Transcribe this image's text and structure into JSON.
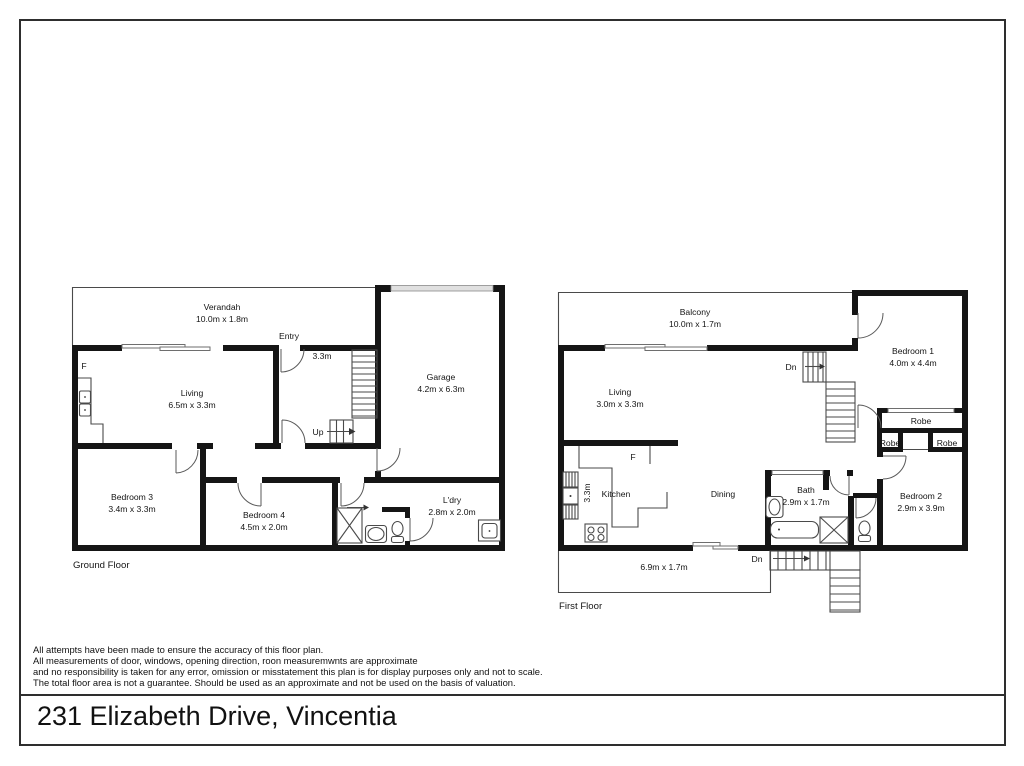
{
  "page": {
    "address": "231 Elizabeth Drive, Vincentia",
    "disclaimer": [
      "All attempts have been made to ensure the accuracy of this floor plan.",
      "All measurements of door, windows, opening direction, roon measuremwnts are approximate",
      "and no responsibility is taken for any error, omission or misstatement this plan is for display purposes only and not to scale.",
      "The total floor area is not a guarantee. Should be used as an approximate and not be used on the basis of valuation."
    ]
  },
  "ground_floor": {
    "label": "Ground Floor",
    "verandah_name": "Verandah",
    "verandah_dims": "10.0m x 1.8m",
    "living_name": "Living",
    "living_dims": "6.5m x 3.3m",
    "entry": "Entry",
    "hall_width": "3.3m",
    "up": "Up",
    "fridge": "F",
    "garage_name": "Garage",
    "garage_dims": "4.2m x 6.3m",
    "bedroom3_name": "Bedroom 3",
    "bedroom3_dims": "3.4m x 3.3m",
    "bedroom4_name": "Bedroom 4",
    "bedroom4_dims": "4.5m x 2.0m",
    "laundry_name": "L'dry",
    "laundry_dims": "2.8m x 2.0m"
  },
  "first_floor": {
    "label": "First Floor",
    "balcony_name": "Balcony",
    "balcony_dims": "10.0m x 1.7m",
    "living_name": "Living",
    "living_dims": "3.0m x 3.3m",
    "bedroom1_name": "Bedroom 1",
    "bedroom1_dims": "4.0m x 4.4m",
    "bedroom2_name": "Bedroom 2",
    "bedroom2_dims": "2.9m x 3.9m",
    "kitchen_name": "Kitchen",
    "kitchen_width": "3.3m",
    "fridge": "F",
    "dining_name": "Dining",
    "bath_name": "Bath",
    "bath_dims": "2.9m x 1.7m",
    "robe_long": "Robe",
    "robe_left": "Robe",
    "robe_right": "Robe",
    "deck_dims": "6.9m x 1.7m",
    "dn_upper": "Dn",
    "dn_lower": "Dn"
  }
}
